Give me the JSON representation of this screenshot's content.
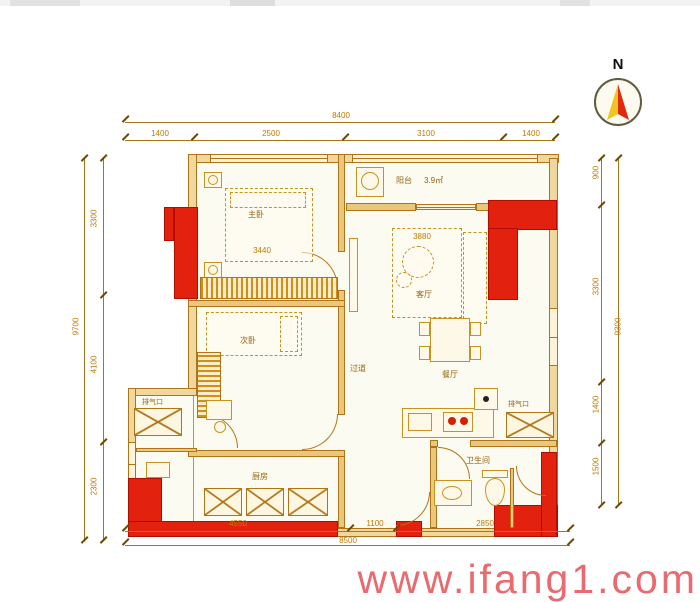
{
  "compass": {
    "label": "N"
  },
  "watermark": {
    "text": "www.ifang1.com"
  },
  "dimensions": {
    "top": {
      "total": "8400",
      "segments": [
        "1400",
        "2500",
        "3100",
        "1400"
      ]
    },
    "bottom": {
      "total": "8500",
      "segments": [
        "4550",
        "1100",
        "2850"
      ]
    },
    "left": {
      "total": "9700",
      "segments": [
        "3300",
        "4100",
        "2300"
      ]
    },
    "right": {
      "total": "9300",
      "segments": [
        "900",
        "3300",
        "1400",
        "1500"
      ]
    }
  },
  "interior_dims": [
    "3440",
    "3880"
  ],
  "rooms": [
    {
      "id": "master-bedroom",
      "label": "主卧"
    },
    {
      "id": "bedroom-2",
      "label": "次卧"
    },
    {
      "id": "living-room",
      "label": "客厅"
    },
    {
      "id": "dining-room",
      "label": "餐厅"
    },
    {
      "id": "kitchen",
      "label": "厨房"
    },
    {
      "id": "bathroom",
      "label": "卫生间"
    },
    {
      "id": "balcony",
      "label": "阳台"
    },
    {
      "id": "hallway",
      "label": "过道"
    }
  ],
  "annotations": {
    "balcony_area": "3.9㎡",
    "vent_left": "排气口",
    "vent_right": "排气口"
  },
  "colors": {
    "wall_accent": "#e2210f",
    "wall_line": "#b07416",
    "dim_text": "#c17a00",
    "watermark": "#e96a6f"
  }
}
